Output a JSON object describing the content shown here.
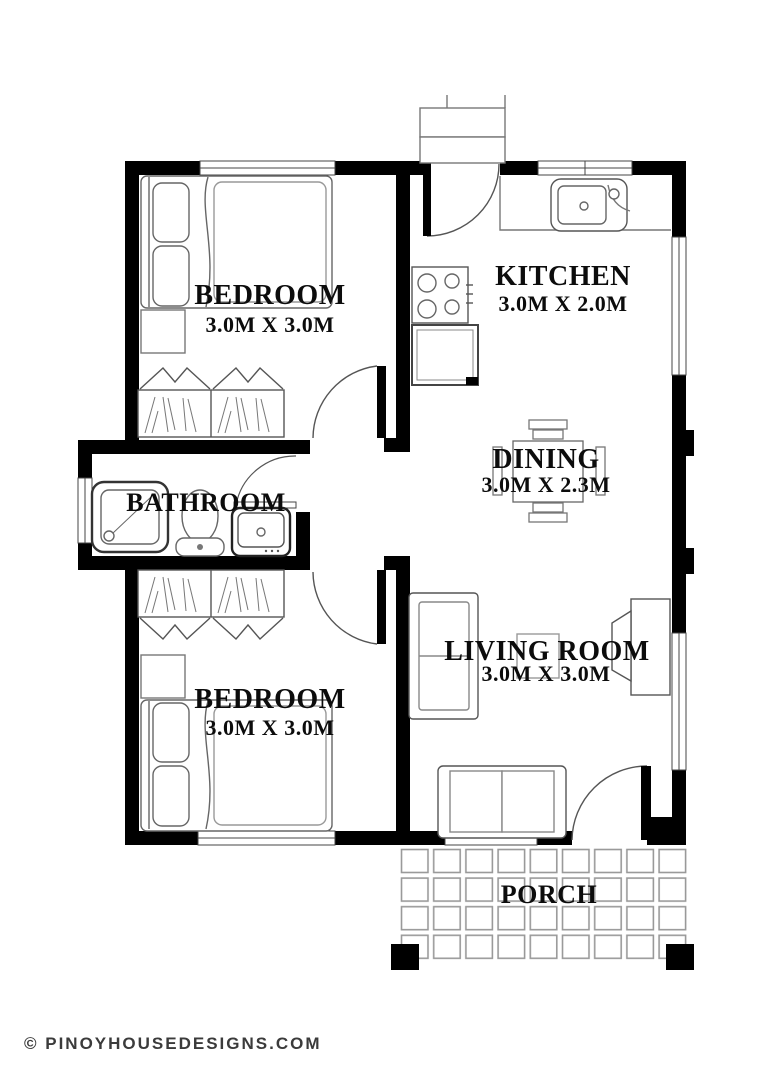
{
  "footer": {
    "copyright": "© PINOYHOUSEDESIGNS.COM"
  },
  "rooms": {
    "bedroom_top": {
      "name": "BEDROOM",
      "size": "3.0M X 3.0M"
    },
    "kitchen": {
      "name": "KITCHEN",
      "size": "3.0M X 2.0M"
    },
    "dining": {
      "name": "DINING",
      "size": "3.0M X 2.3M"
    },
    "bathroom": {
      "name": "BATHROOM"
    },
    "bedroom_bottom": {
      "name": "BEDROOM",
      "size": "3.0M X 3.0M"
    },
    "living_room": {
      "name": "LIVING ROOM",
      "size": "3.0M X 3.0M"
    },
    "porch": {
      "name": "PORCH"
    }
  },
  "fixtures": {
    "bedroom_top": [
      "bed",
      "bedside-table",
      "wardrobe",
      "door"
    ],
    "kitchen": [
      "entry-step",
      "entry-door",
      "counter",
      "sink",
      "stove",
      "refrigerator"
    ],
    "dining": [
      "dining-table",
      "chairs"
    ],
    "bathroom": [
      "shower",
      "toilet",
      "lavatory",
      "window",
      "door"
    ],
    "bedroom_bottom": [
      "wardrobe",
      "bedside-table",
      "bed",
      "door"
    ],
    "living_room": [
      "loveseat",
      "coffee-table",
      "tv-cabinet",
      "sofa",
      "front-door"
    ],
    "porch": [
      "floor-tiles",
      "columns"
    ]
  },
  "colors": {
    "wall": "#000000",
    "furniture_line": "#666666",
    "tile_line": "#999999",
    "label_text": "#0c0c0c",
    "footer_text": "#3b3b3b"
  }
}
